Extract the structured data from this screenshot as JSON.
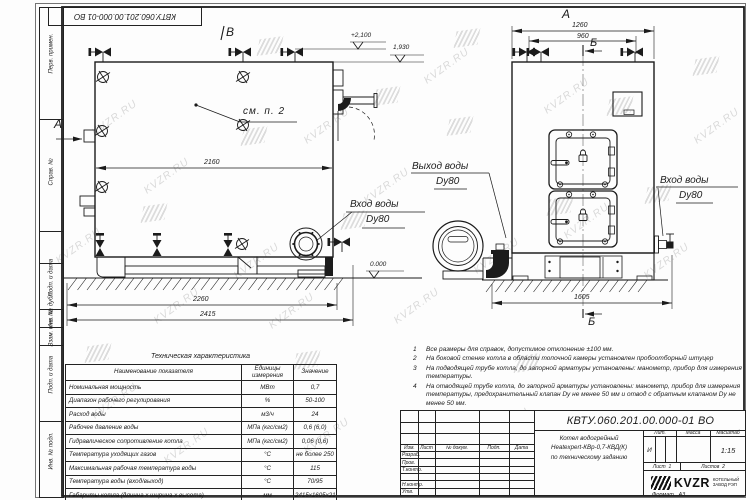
{
  "doc": {
    "number": "КВТУ.060.201.00.000-01 ВО",
    "product_line1": "Котел водогрейный",
    "product_line2": "Heatexpert-КВр-0,7-КВД(К)",
    "product_line3": "по техническому заданию",
    "lit_value": "И",
    "scale_value": "1:15",
    "sheet_label": "Лист",
    "sheet_value": "1",
    "sheets_label": "Листов",
    "sheets_value": "2",
    "format_label": "Формат",
    "format_value": "А3",
    "org": {
      "logo": "KVZR",
      "line1": "КОТЕЛЬНЫЙ",
      "line2": "ЗАВОД РЭП"
    }
  },
  "title_block": {
    "col_izm": "Изм.",
    "col_list": "Лист",
    "col_doc": "№ докум.",
    "col_sign": "Подп.",
    "col_date": "Дата",
    "rows": [
      "Разраб.",
      "Пров.",
      "Т.контр.",
      "",
      "Н.контр.",
      "Утв."
    ],
    "lit_header": "Лит.",
    "mass_header": "Масса",
    "scale_header": "Масштаб"
  },
  "margin_labels": [
    "Перв. примен.",
    "Справ. №",
    "Подп. и дата",
    "Инв. № дубл.",
    "Взам. инв. №",
    "Подп. и дата",
    "Инв. № подл."
  ],
  "tech_table": {
    "title": "Техническая характеристика",
    "headers": [
      "Наименование показателя",
      "Единицы измерения",
      "Значение"
    ],
    "rows": [
      [
        "Номинальная мощность",
        "МВт",
        "0,7"
      ],
      [
        "Диапазон рабочего регулирования",
        "%",
        "50-100"
      ],
      [
        "Расход воды",
        "м3/ч",
        "24"
      ],
      [
        "Рабочее давление воды",
        "МПа (кгс/см2)",
        "0,6 (6,0)"
      ],
      [
        "Гидравлическое сопротивление котла",
        "МПа (кгс/см2)",
        "0,06 (0,6)"
      ],
      [
        "Температура уходящих газов",
        "°С",
        "не более 250"
      ],
      [
        "Максимальная рабочая температура воды",
        "°С",
        "115"
      ],
      [
        "Температура воды (вход/выход)",
        "°С",
        "70/95"
      ],
      [
        "Габариты котла (длинна х ширина х высота)",
        "мм",
        "2415х1605х2100"
      ]
    ]
  },
  "notes": [
    {
      "n": "1",
      "text": "Все размеры для справок, допустимое отклонение ±100 мм."
    },
    {
      "n": "2",
      "text": "На боковой стенке котла в области топочной камеры установлен пробоотборный штуцер"
    },
    {
      "n": "3",
      "text": "На подводящей трубе котла, до запорной арматуры установлены: манометр, прибор для измерения температуры."
    },
    {
      "n": "4",
      "text": "На отводящей трубе котла, до запорной арматуры установлены: манометр, прибор для измерения температуры, предохранительный клапан Dу не менее 50 мм и отвод с обратным клапаном Dу не менее 50 мм."
    }
  ],
  "dimensions": {
    "side_width": "2160",
    "side_len1": "2260",
    "side_len2": "2415",
    "front_w1": "1260",
    "front_w2": "960",
    "front_len": "1605"
  },
  "levels": {
    "top": "+2,100",
    "duct": "1,930",
    "zero": "0.000"
  },
  "markers": {
    "a": "А",
    "b": "Б",
    "v": "В"
  },
  "callouts": {
    "see_note": "см. п. 2",
    "inlet": "Вход воды",
    "outlet": "Выход воды",
    "dy": "Dy80"
  },
  "watermark": "KVZR.RU",
  "colors": {
    "line": "#1b1b1b",
    "watermark": "#bdbdbd",
    "paper": "#fdfdfd"
  }
}
